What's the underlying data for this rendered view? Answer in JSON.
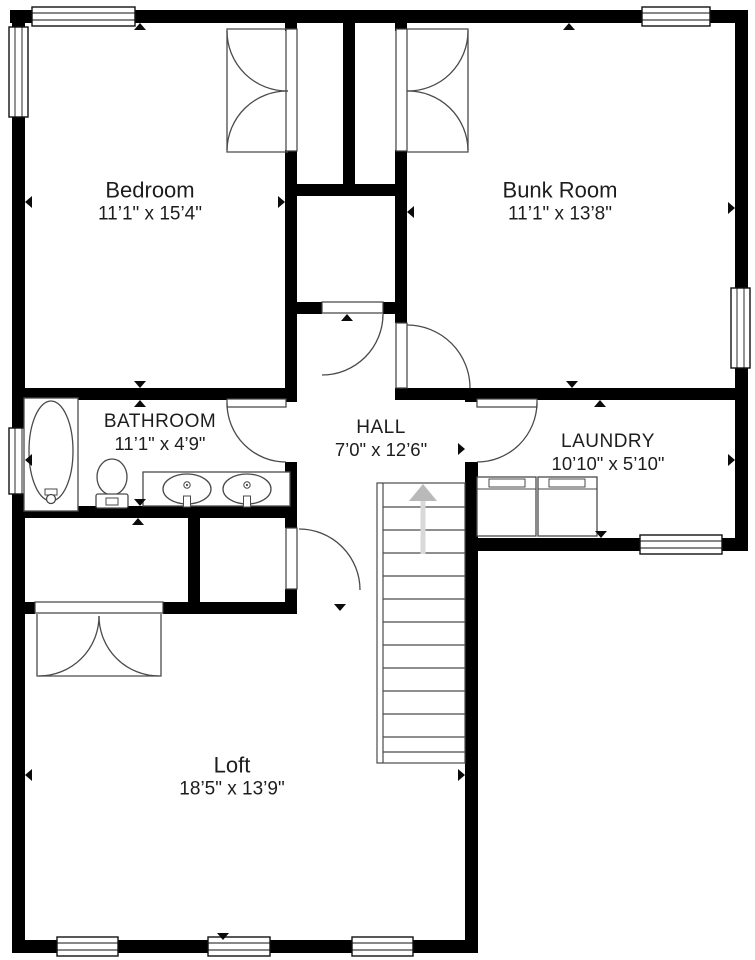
{
  "floorplan": {
    "title": "Second floor plan",
    "rooms": [
      {
        "id": "bedroom",
        "name": "Bedroom",
        "dimensions": "11’1\" x 15’4\""
      },
      {
        "id": "bunkroom",
        "name": "Bunk Room",
        "dimensions": "11’1\" x 13’8\""
      },
      {
        "id": "bathroom",
        "name": "BATHROOM",
        "dimensions": "11’1\" x 4’9\""
      },
      {
        "id": "hall",
        "name": "HALL",
        "dimensions": "7’0\" x 12’6\""
      },
      {
        "id": "laundry",
        "name": "LAUNDRY",
        "dimensions": "10’10\" x 5’10\""
      },
      {
        "id": "loft",
        "name": "Loft",
        "dimensions": "18’5\" x 13’9\""
      }
    ],
    "symbols": [
      "window",
      "door-swing",
      "double-closet-doors",
      "staircase-up-arrow",
      "bathtub",
      "toilet",
      "double-vanity-sinks",
      "washer",
      "dryer",
      "dimension-marker"
    ],
    "colors": {
      "wall": "#000000",
      "background": "#ffffff",
      "fixture_line": "#4a4a4a",
      "stair_arrow_head": "#b9b9b9",
      "stair_arrow_shaft": "#d9d9d9",
      "text": "#1d1d1d"
    }
  }
}
